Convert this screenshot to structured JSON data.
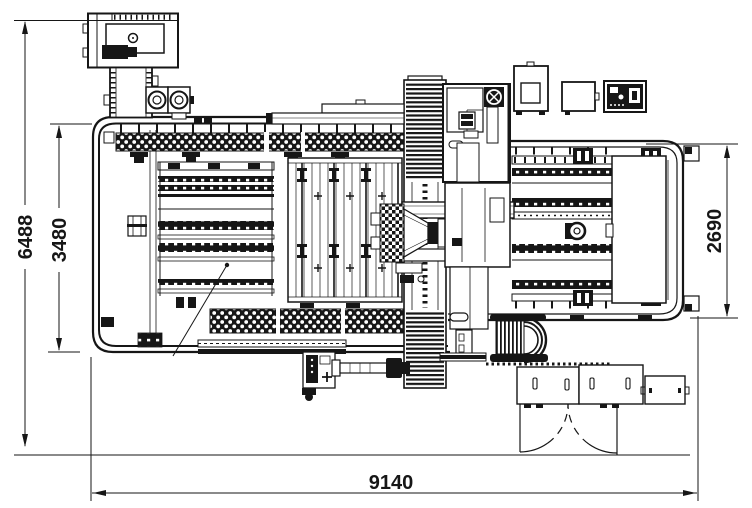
{
  "page": {
    "background": "#ffffff",
    "line_color": "#161616"
  },
  "drawing": {
    "kind": "technical dimensional drawing (plan view of CNC machining centre)",
    "dimensions": {
      "overall_depth": {
        "value": "6488",
        "orientation": "vertical-left-outer"
      },
      "left_table_depth": {
        "value": "3480",
        "orientation": "vertical-left-inner"
      },
      "right_table_depth": {
        "value": "2690",
        "orientation": "vertical-right"
      },
      "overall_length": {
        "value": "9140",
        "orientation": "horizontal-bottom"
      }
    }
  }
}
